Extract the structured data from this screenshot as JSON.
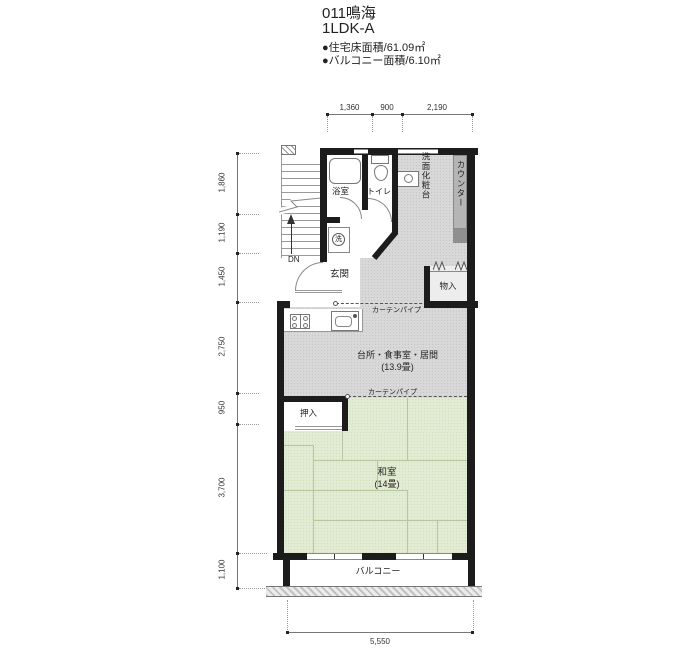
{
  "header": {
    "title": "011鳴海",
    "plan_type": "1LDK-A",
    "floor_area": "●住宅床面積/61.09㎡",
    "balcony_area": "●バルコニー面積/6.10㎡"
  },
  "dimensions": {
    "top": [
      "1,360",
      "900",
      "2,190"
    ],
    "left": [
      "1,860",
      "1,190",
      "1,450",
      "2,750",
      "950",
      "3,700",
      "1,100"
    ],
    "bottom": "5,550"
  },
  "labels": {
    "bath": "浴室",
    "toilet": "トイレ",
    "vanity": "洗面化粧台",
    "counter": "カウンター",
    "washer": "洗",
    "entrance": "玄関",
    "down": "DN",
    "storage": "物入",
    "curtain_pipe": "カーテンパイプ",
    "ldk": "台所・食事室・居間",
    "ldk_size": "(13.9畳)",
    "closet": "押入",
    "tatami_room": "和室",
    "tatami_size": "(14畳)",
    "balcony": "バルコニー"
  },
  "colors": {
    "wall": "#1c1c1c",
    "ldk_floor": "#d8d8d8",
    "tatami_floor": "#e2ebd3",
    "counter": "#b5b5b5"
  }
}
